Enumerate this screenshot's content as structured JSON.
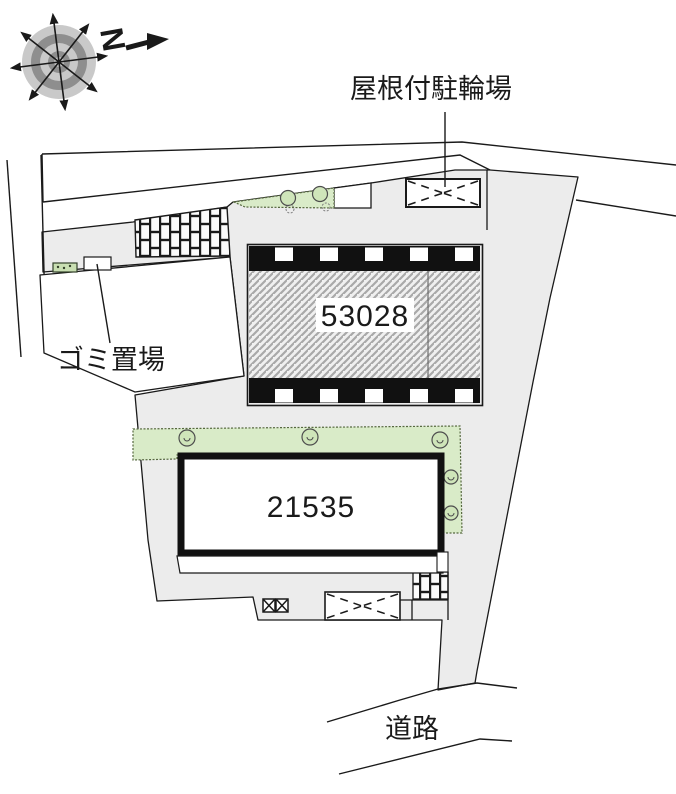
{
  "map": {
    "compass": {
      "letter": "N"
    },
    "labels": {
      "bicycle_parking": "屋根付駐輪場",
      "garbage": "ゴミ置場",
      "road": "道路"
    },
    "buildings": [
      {
        "number": "53028"
      },
      {
        "number": "21535"
      }
    ],
    "colors": {
      "plot_fill": "#ececec",
      "green_fill": "#d9ebc8",
      "line": "#1a1a1a",
      "hatch_line": "#a9a9a9",
      "compass_ring_light": "#c9c9c9",
      "compass_ring_dark": "#8e8e8e"
    }
  }
}
